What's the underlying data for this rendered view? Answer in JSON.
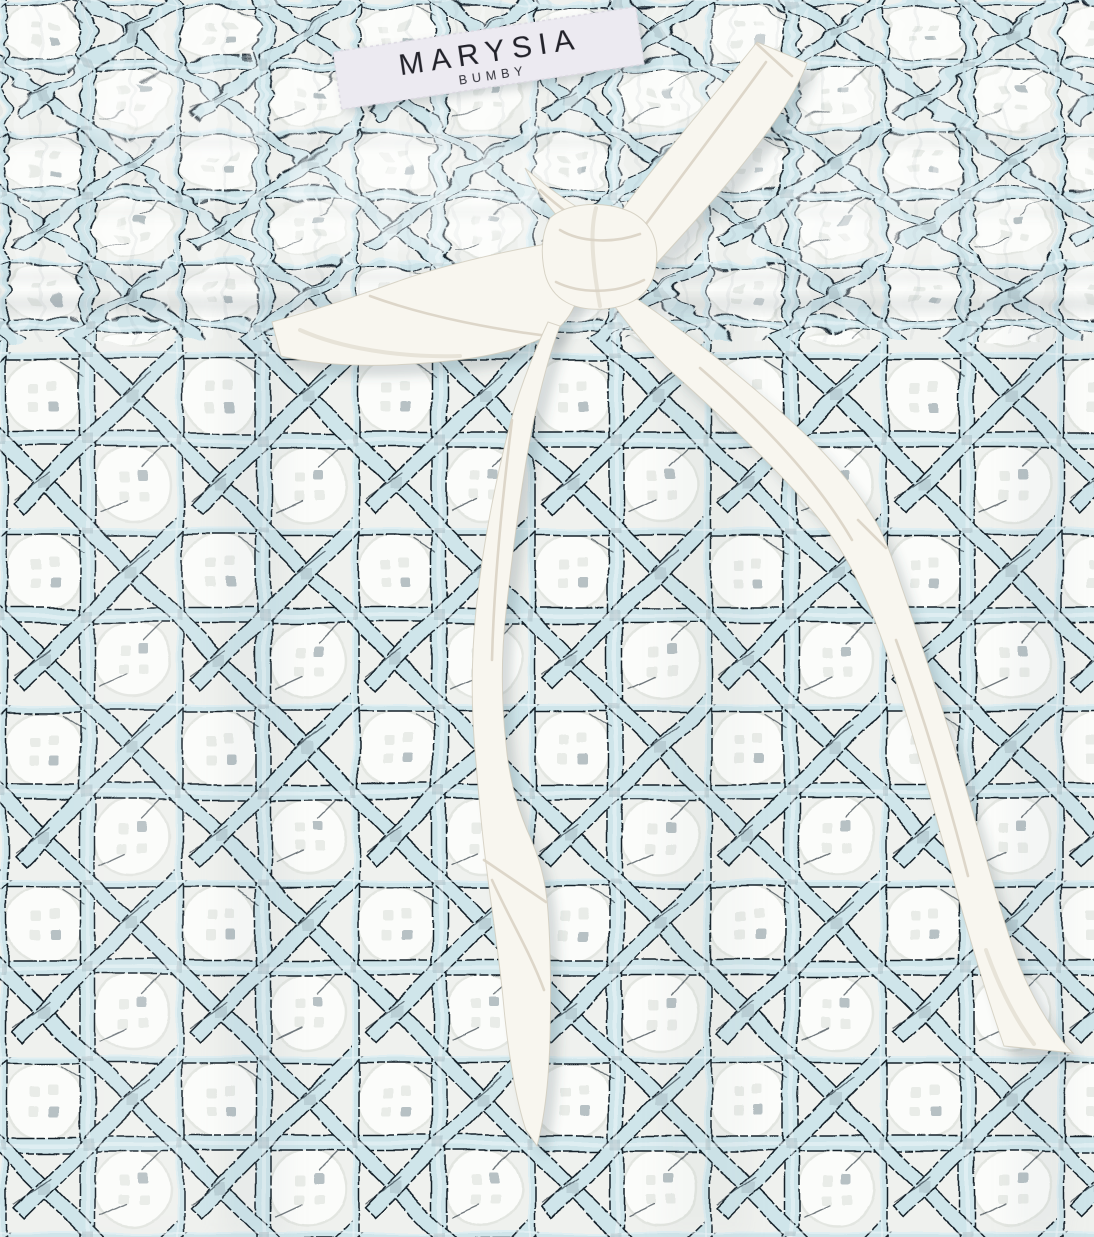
{
  "photo": {
    "description": "Close-up product photo of a white garment with smocked elastic waistband, printed all over with a light-blue rattan cane-weave lattice over white eyelet fabric, and a white drawstring ribbon tied in a bow whose two tails hang down the front",
    "colors": {
      "fabric_base": "#eff1ee",
      "cane_strip": "#cfe5ea",
      "cane_outline": "#16222c",
      "accent_gray": "#9fb2ba",
      "ribbon": "#f8f6ef",
      "ribbon_edge": "#cfcabc",
      "ribbon_crease": "#d9d3c4",
      "label_bg": "#eceaf1",
      "label_text": "#22222a"
    }
  },
  "label": {
    "brand": "MARYSIA",
    "sub_brand": "BUMBY"
  }
}
